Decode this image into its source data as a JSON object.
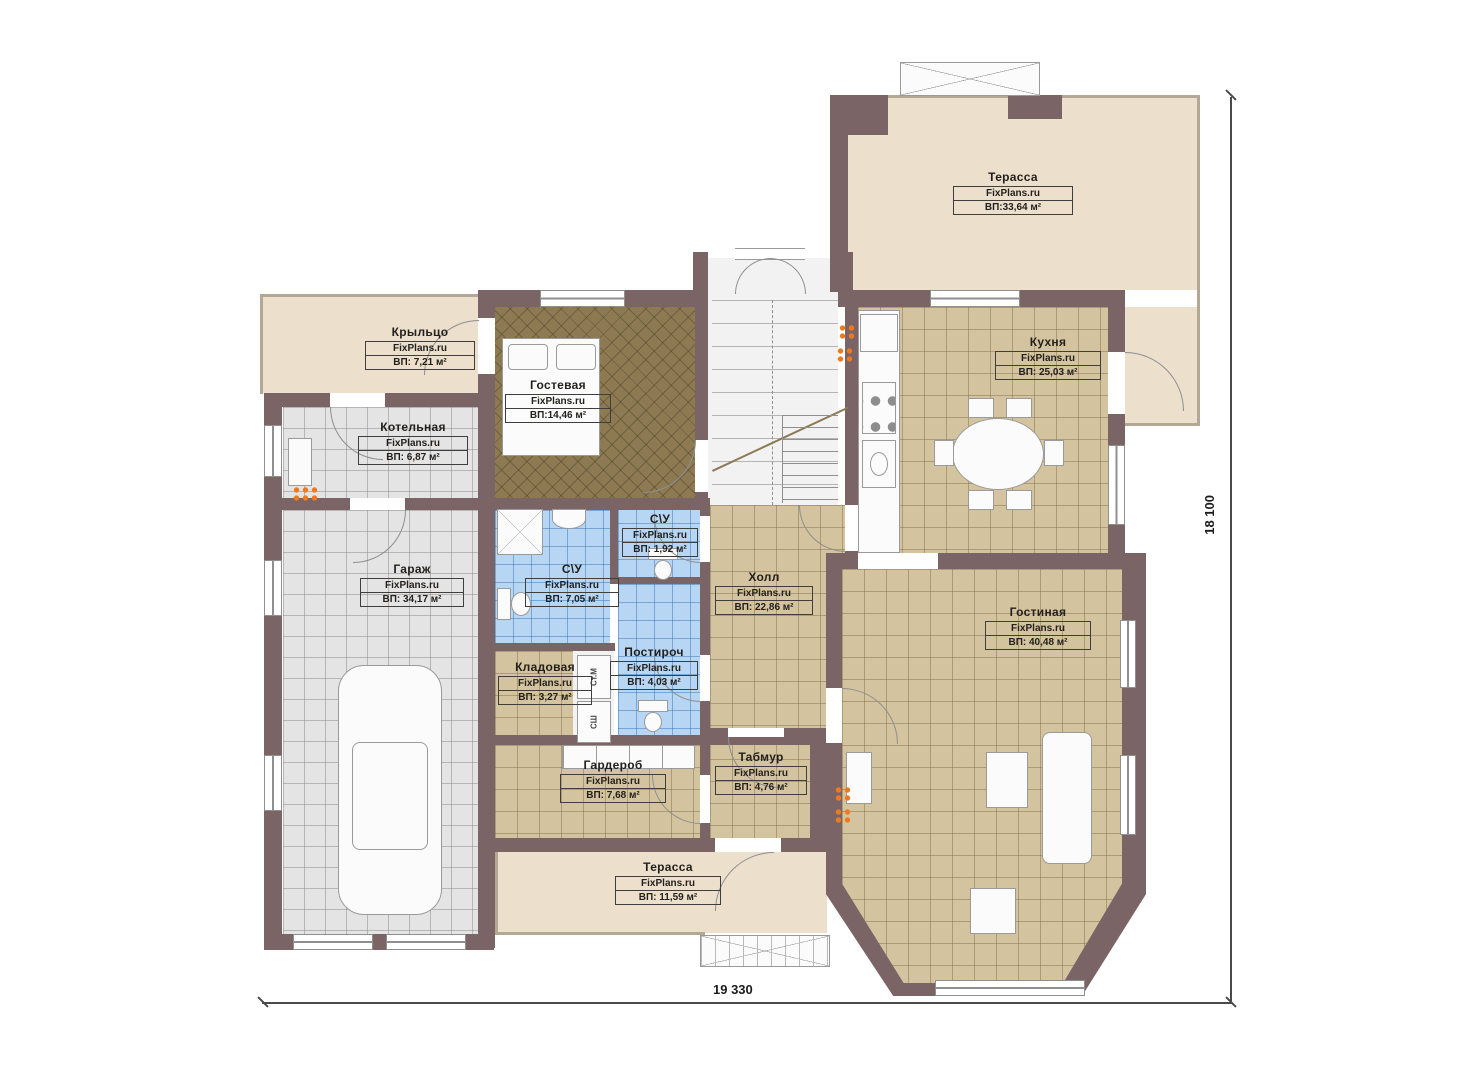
{
  "plan": {
    "brand": "FixPlans.ru",
    "rooms": [
      {
        "name": "Терасса",
        "brand": "FixPlans.ru",
        "area": "ВП:33,64 м²"
      },
      {
        "name": "Крыльцо",
        "brand": "FixPlans.ru",
        "area": "ВП: 7,21 м²"
      },
      {
        "name": "Котельная",
        "brand": "FixPlans.ru",
        "area": "ВП: 6,87 м²"
      },
      {
        "name": "Гостевая",
        "brand": "FixPlans.ru",
        "area": "ВП:14,46 м²"
      },
      {
        "name": "Кухня",
        "brand": "FixPlans.ru",
        "area": "ВП: 25,03 м²"
      },
      {
        "name": "Гараж",
        "brand": "FixPlans.ru",
        "area": "ВП: 34,17 м²"
      },
      {
        "name": "С\\У",
        "brand": "FixPlans.ru",
        "area": "ВП: 1,92 м²"
      },
      {
        "name": "С\\У",
        "brand": "FixPlans.ru",
        "area": "ВП: 7,05 м²"
      },
      {
        "name": "Холл",
        "brand": "FixPlans.ru",
        "area": "ВП: 22,86 м²"
      },
      {
        "name": "Гостиная",
        "brand": "FixPlans.ru",
        "area": "ВП: 40,48 м²"
      },
      {
        "name": "Постироч",
        "brand": "FixPlans.ru",
        "area": "ВП: 4,03 м²"
      },
      {
        "name": "Кладовая",
        "brand": "FixPlans.ru",
        "area": "ВП: 3,27 м²"
      },
      {
        "name": "Гардероб",
        "brand": "FixPlans.ru",
        "area": "ВП: 7,68 м²"
      },
      {
        "name": "Табмур",
        "brand": "FixPlans.ru",
        "area": "ВП: 4,76 м²"
      },
      {
        "name": "Терасса",
        "brand": "FixPlans.ru",
        "area": "ВП: 11,59 м²"
      }
    ],
    "appliances": {
      "washer": "Ст.М",
      "dryer": "СШ"
    },
    "dimensions": {
      "vertical": "18 100",
      "horizontal": "19 330"
    },
    "colors": {
      "wall": "#7a6466",
      "terrace": "#ecdfcc",
      "tile_tan": "#d3c39e",
      "tile_blue": "#b6d6f4",
      "tile_gray": "#e4e4e4",
      "guest_floor": "#8d7a52",
      "marker_orange": "#f0791d"
    }
  }
}
